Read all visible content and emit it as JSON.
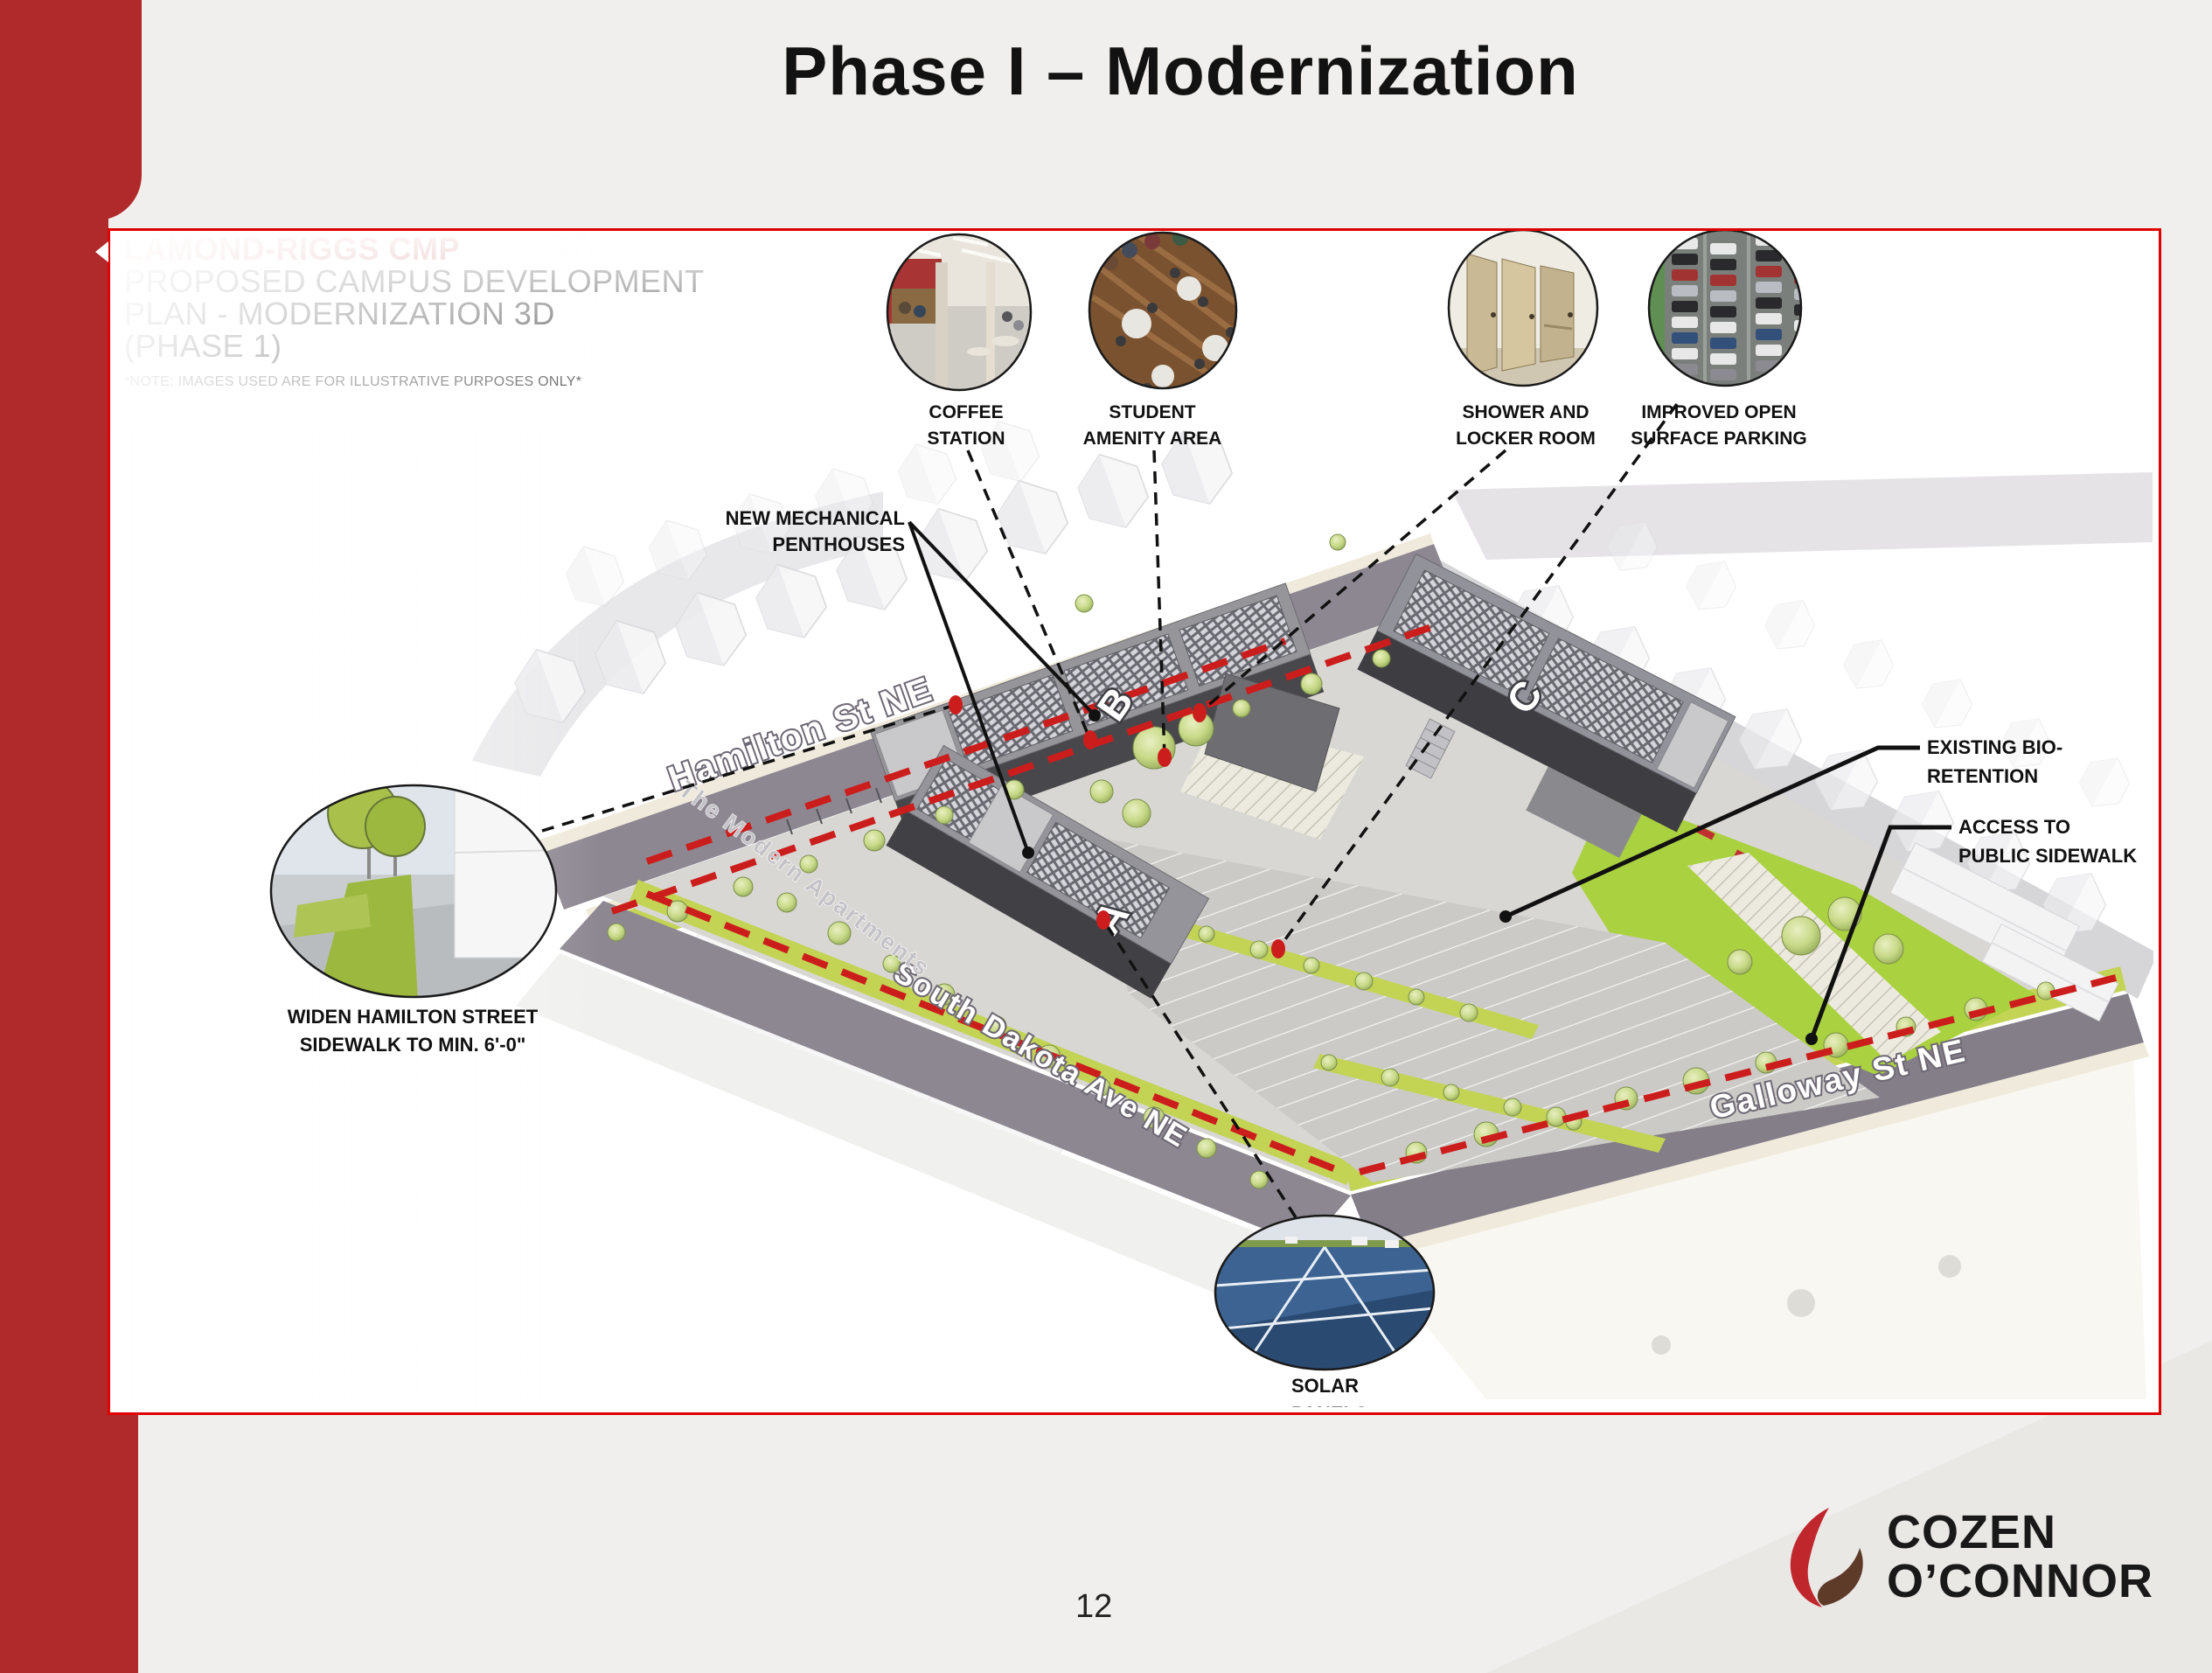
{
  "slide": {
    "title": "Phase I – Modernization",
    "page_number": "12"
  },
  "panel": {
    "heading_red": "LAMOND-RIGGS CMP",
    "heading_lines": [
      "PROPOSED CAMPUS DEVELOPMENT",
      "PLAN - MODERNIZATION 3D",
      "(PHASE 1)"
    ],
    "note": "*NOTE: IMAGES USED ARE FOR ILLUSTRATIVE PURPOSES ONLY*"
  },
  "streets": {
    "hamilton": "Hamilton St NE",
    "south_dakota": "South Dakota Ave NE",
    "galloway": "Galloway St NE",
    "modern_apartments": "The Modern Apartments"
  },
  "buildings": {
    "a": "A",
    "b": "B",
    "c": "C"
  },
  "callouts": {
    "coffee": {
      "lines": [
        "COFFEE",
        "STATION"
      ]
    },
    "student": {
      "lines": [
        "STUDENT",
        "AMENITY AREA"
      ]
    },
    "shower": {
      "lines": [
        "SHOWER AND",
        "LOCKER ROOM"
      ]
    },
    "parking": {
      "lines": [
        "IMPROVED OPEN",
        "SURFACE PARKING"
      ]
    },
    "penthouses": {
      "lines": [
        "NEW MECHANICAL",
        "PENTHOUSES"
      ]
    },
    "bio": {
      "lines": [
        "EXISTING BIO-",
        "RETENTION"
      ]
    },
    "access": {
      "lines": [
        "ACCESS TO",
        "PUBLIC SIDEWALK"
      ]
    },
    "widen": {
      "lines": [
        "WIDEN HAMILTON STREET",
        "SIDEWALK TO MIN. 6'-0\""
      ]
    },
    "solar": {
      "lines": [
        "SOLAR",
        "PANELS"
      ]
    }
  },
  "logo": {
    "line1": "COZEN",
    "line2": "O’CONNOR"
  },
  "colors": {
    "accent_red": "#b02a2b",
    "border_red": "#e00000",
    "dash_red": "#cc1d1d",
    "lawn_green": "#aad13f",
    "strip_green": "#c3d455"
  }
}
